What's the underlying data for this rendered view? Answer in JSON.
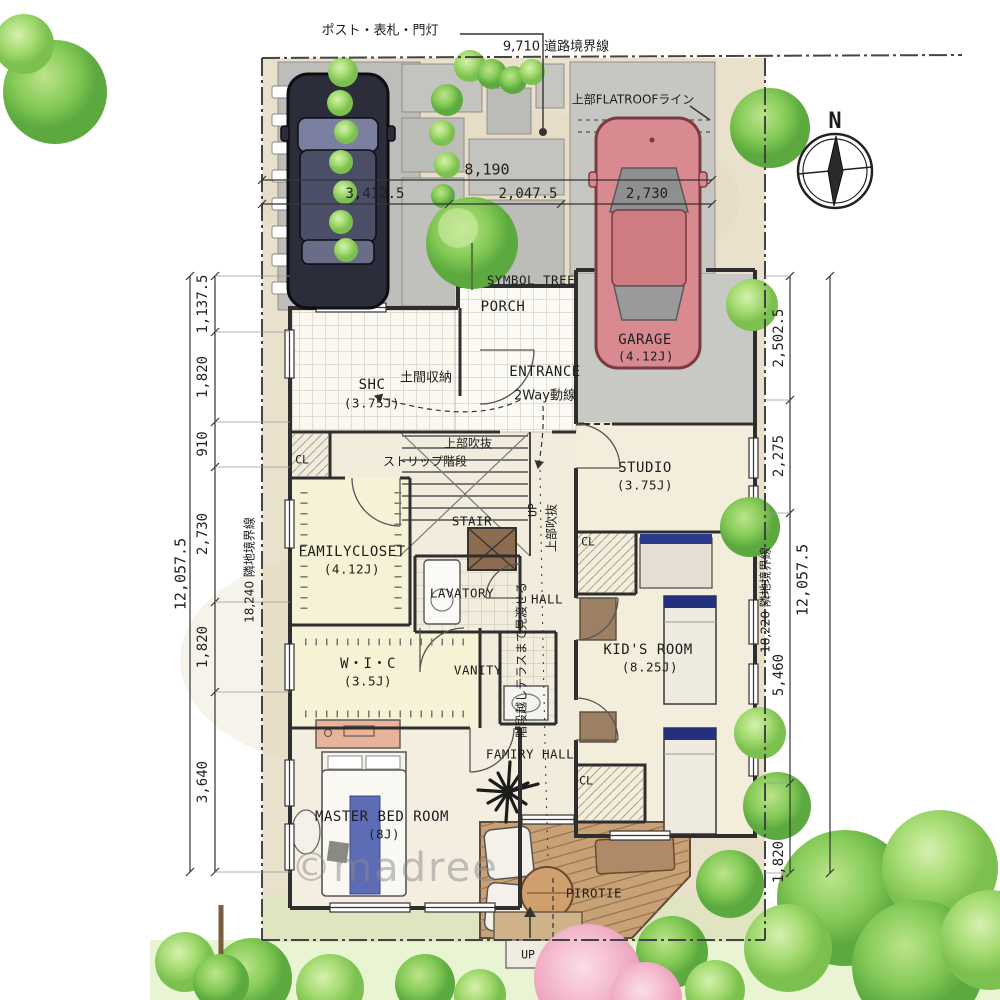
{
  "title_note": "ポスト・表札・門灯",
  "boundaries": {
    "road": "9,710 道路境界線",
    "left": "18,240 隣地境界線",
    "right": "18,220 隣地境界線",
    "left_total": "12,057.5",
    "right_total": "12,057.5"
  },
  "dims": {
    "top_total": "8,190",
    "top_segments": [
      "3,412.5",
      "2,047.5",
      "2,730"
    ],
    "left_segments": [
      "1,137.5",
      "1,820",
      "910",
      "2,730",
      "1,820",
      "3,640"
    ],
    "right_segments": [
      "2,502.5",
      "2,275",
      "5,460",
      "1,820"
    ]
  },
  "notes": {
    "flatroof": "上部FLATROOFライン",
    "symbol_tree": "SYMBOL TREE",
    "two_way": "2Way動線",
    "strip_stair": "ストリップ階段",
    "void_upper": "上部吹抜",
    "terrace_view": "階段越しテラスまで見渡せる",
    "doma": "土間収納",
    "up": "UP",
    "cl": "CL"
  },
  "rooms": {
    "porch": "PORCH",
    "entrance": "ENTRANCE",
    "shc": {
      "name": "SHC",
      "size": "(3.75J)"
    },
    "studio": {
      "name": "STUDIO",
      "size": "(3.75J)"
    },
    "garage": {
      "name": "GARAGE",
      "size": "(4.12J)"
    },
    "familycloset": {
      "name": "FAMILYCLOSET",
      "size": "(4.12J)"
    },
    "stair": "STAIR",
    "lavatory": "LAVATORY",
    "hall": "HALL",
    "wic": {
      "name": "W・I・C",
      "size": "(3.5J)"
    },
    "vanity": "VANITY",
    "kids": {
      "name": "KID'S ROOM",
      "size": "(8.25J)"
    },
    "master": {
      "name": "MASTER BED ROOM",
      "size": "(8J)"
    },
    "famiry_hall": "FAMIRY HALL",
    "pirotie": "PIROTIE"
  },
  "compass": {
    "north": "N"
  },
  "watermark": "©madree",
  "colors": {
    "site_beige": "#eae1cc",
    "wall": "#2e2e2e",
    "red_car": "#d88a90",
    "black_car": "#2b2d3a",
    "tree_green": "#8ccf63",
    "tatami_yellow": "#f6f2d6",
    "deck_wood": "#c9a176",
    "pink_tree": "#f3bed0"
  }
}
